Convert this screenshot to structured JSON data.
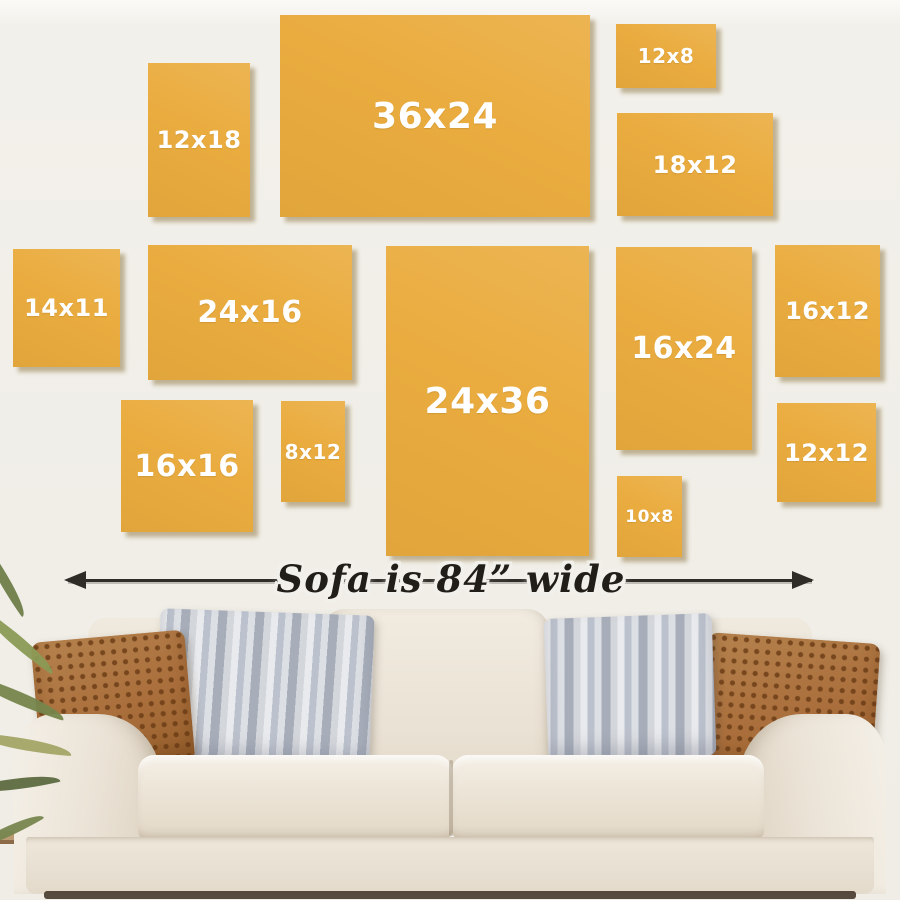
{
  "frames": [
    {
      "label": "12x18"
    },
    {
      "label": "36x24"
    },
    {
      "label": "12x8"
    },
    {
      "label": "18x12"
    },
    {
      "label": "14x11"
    },
    {
      "label": "24x16"
    },
    {
      "label": "24x36"
    },
    {
      "label": "16x24"
    },
    {
      "label": "16x12"
    },
    {
      "label": "16x16"
    },
    {
      "label": "8x12"
    },
    {
      "label": "10x8"
    },
    {
      "label": "12x12"
    }
  ],
  "dimension": {
    "text": "Sofa is 84” wide"
  },
  "colors": {
    "frame_yellow": "#eaac3f",
    "label_white": "#ffffff",
    "arrow_black": "#2f2c27",
    "wall": "#f0eee7",
    "sofa_cream": "#eae2d4",
    "pillow_brown": "#aa6f3c",
    "pillow_gray": "#bcc2cd"
  }
}
